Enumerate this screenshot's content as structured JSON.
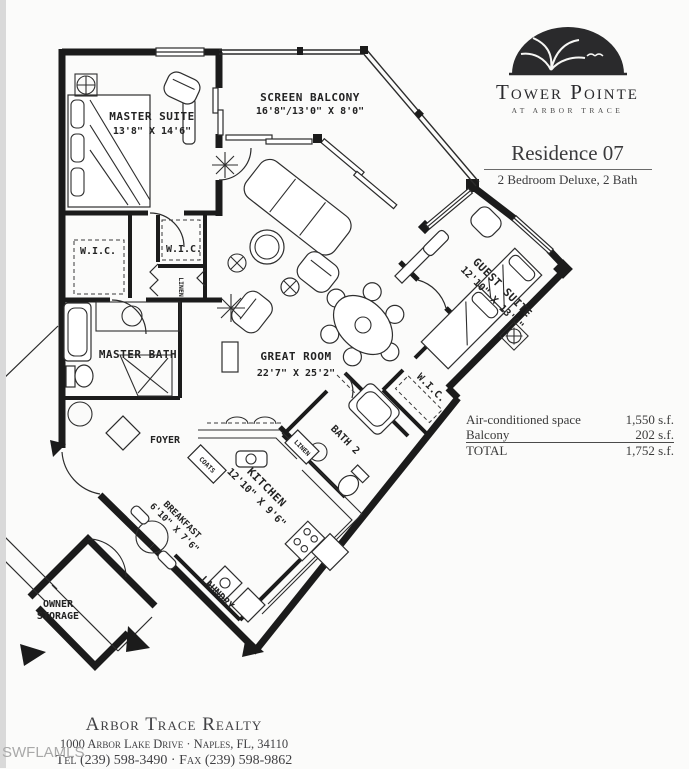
{
  "branding": {
    "logo_title": "Tower Pointe",
    "logo_subtitle": "AT ARBOR TRACE"
  },
  "header": {
    "residence": "Residence 07",
    "type": "2 Bedroom Deluxe, 2 Bath"
  },
  "rooms": {
    "screen_balcony": {
      "name": "SCREEN BALCONY",
      "dims": "16'8\"/13'0\" X 8'0\""
    },
    "master_suite": {
      "name": "MASTER SUITE",
      "dims": "13'8\" X 14'6\""
    },
    "great_room": {
      "name": "GREAT ROOM",
      "dims": "22'7\" X 25'2\""
    },
    "guest_suite": {
      "name": "GUEST SUITE",
      "dims": "12'10\" X 13'0\""
    },
    "kitchen": {
      "name": "KITCHEN",
      "dims": "12'10\" X 9'6\""
    },
    "breakfast": {
      "name": "BREAKFAST",
      "dims": "6'10\" X 7'6\""
    },
    "master_bath": {
      "name": "MASTER BATH"
    },
    "foyer": {
      "name": "FOYER"
    },
    "bath_2": {
      "name": "BATH 2"
    },
    "laundry": {
      "name": "LAUNDRY"
    },
    "owner_storage": {
      "line1": "OWNER",
      "line2": "STORAGE"
    },
    "wic": "W.I.C.",
    "linen": "LINEN",
    "coats": "COATS"
  },
  "area_table": {
    "rows": [
      {
        "label": "Air-conditioned space",
        "value": "1,550 s.f."
      },
      {
        "label": "Balcony",
        "value": "202 s.f."
      },
      {
        "label": "TOTAL",
        "value": "1,752 s.f."
      }
    ]
  },
  "footer": {
    "realty": "Arbor Trace Realty",
    "address": "1000 Arbor Lake Drive · Naples, FL, 34110",
    "phone": "Tel (239) 598-3490 · Fax (239) 598-9862"
  },
  "watermark": "SWFLAMLS",
  "colors": {
    "wall": "#1b1b1b",
    "paper": "#fbfbfa",
    "watermark_gray": "#a9a9a9"
  }
}
